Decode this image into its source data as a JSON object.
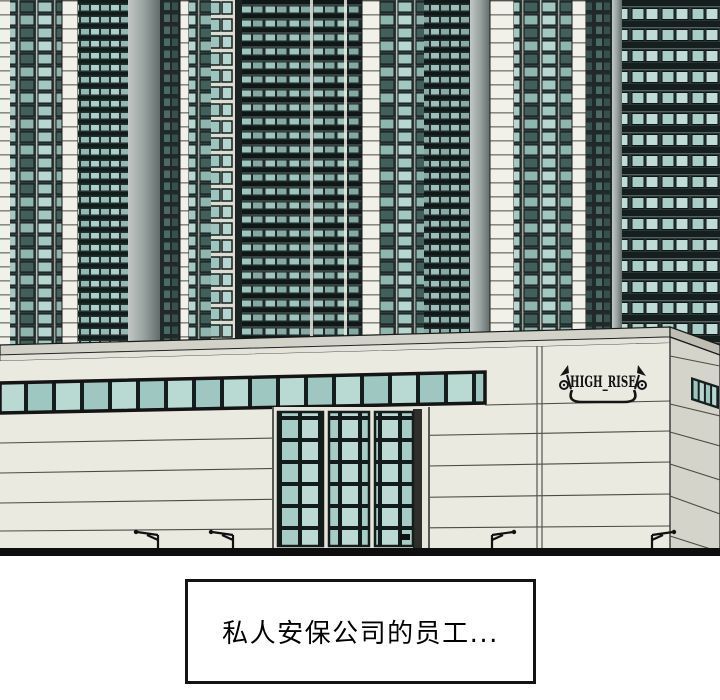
{
  "panel": {
    "caption_text": "私人安保公司的员工...",
    "sign_text": "HIGH_RISE",
    "street_lamp_count": 4,
    "colors": {
      "ink": "#141414",
      "paper": "#ffffff",
      "cream_wall": "#ebeae1",
      "side_wall": "#d5d4cb",
      "roof_coping": "#d2d2c9",
      "glass_teal": "#aed2cb",
      "glass_teal_light": "#c3dfd8",
      "facade_dark": "#2a3635",
      "white_column": "#f1f0e9",
      "pillar_gray": "#98a2a0"
    }
  }
}
